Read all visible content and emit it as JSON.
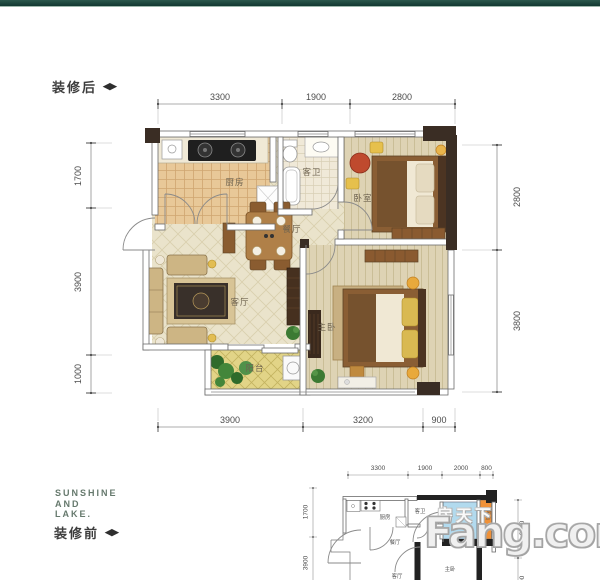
{
  "theme": {
    "top_bar_color": "#1d4a40",
    "accent_blue": "#b2daee",
    "accent_orange": "#ef9138",
    "dim_text_color": "#4c4c4c",
    "room_label_color": "#6e6350"
  },
  "after_plan": {
    "section_label": "装修后",
    "toggle_icon": "◀▶",
    "dims": {
      "top": [
        "3300",
        "1900",
        "2800"
      ],
      "bottom": [
        "3900",
        "3200",
        "900"
      ],
      "left": [
        "1700",
        "3900",
        "1000"
      ],
      "right": [
        "2800",
        "3800"
      ]
    },
    "rooms": {
      "kitchen": "厨房",
      "guest_bath": "客卫",
      "bedroom": "卧室",
      "dining": "餐厅",
      "living": "客厅",
      "master_bedroom": "主卧",
      "balcony": "阳台"
    }
  },
  "before_plan": {
    "section_label": "装修前",
    "toggle_icon": "◀▶",
    "brand": {
      "lines": [
        "SUNSHINE",
        "AND",
        "LAKE."
      ]
    },
    "dims": {
      "top": [
        "3300",
        "1900",
        "2000",
        "800"
      ],
      "left": [
        "1700",
        "3900"
      ],
      "right": [
        "2800",
        "3800"
      ]
    },
    "rooms": {
      "kitchen": "厨房",
      "guest_bath": "客卫",
      "dining": "餐厅",
      "living": "客厅",
      "master_bedroom": "主卧",
      "balcony": "阳台"
    }
  },
  "watermark": {
    "cn": "房天下",
    "en": "Fang.com"
  }
}
